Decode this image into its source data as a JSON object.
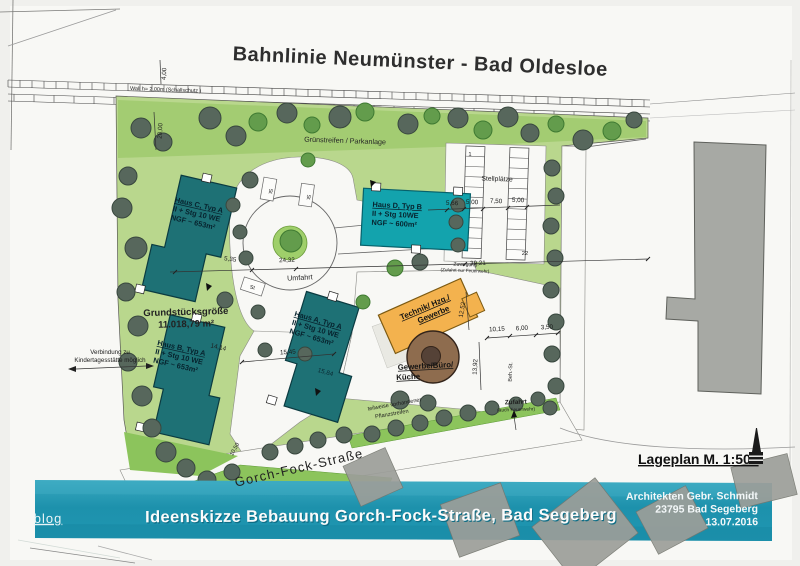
{
  "plan": {
    "railway": "Bahnlinie Neumünster - Bad Oldesloe",
    "wall": "Wall h= 2,00m   (Schallschutz )",
    "green_strip": "Grünstreifen / Parkanlage",
    "stellplaetze": "Stellplätze",
    "stall_first": "1",
    "stall_last": "22",
    "st": "St",
    "umfahrt": "Umfahrt",
    "plot_size_1": "Grundstücksgröße",
    "plot_size_2": "11.018,79 m²",
    "kita_1": "Verbindung zu",
    "kita_2": "Kindertagesstätte möglich",
    "pflanz_1": "teilweise vorhandener",
    "pflanz_2": "Pflanzstreifen",
    "zufahrt_1": "Zufahrt",
    "zufahrt_2": "(auch Feuerwehr)",
    "zuwegung_1": "Zuwegung",
    "zuwegung_2": "(Zufahrt nur Feuerwehr)",
    "street": "Gorch-Fock-Straße",
    "scale": "Lageplan M. 1:500",
    "beh_st": "Beh.-St."
  },
  "buildings": {
    "haus_c": {
      "name": "Haus C, Typ A",
      "line2": "II + Stg 10 WE",
      "line3": "NGF ~ 653m²"
    },
    "haus_d": {
      "name": "Haus D,  Typ B",
      "line2": "II + Stg 10WE",
      "line3": "NGF ~ 600m²"
    },
    "haus_a": {
      "name": "Haus A, Typ A",
      "line2": "II + Stg 10 WE",
      "line3": "NGF ~ 653m²"
    },
    "haus_b": {
      "name": "Haus B, Typ A",
      "line2": "II + Stg 10 WE",
      "line3": "NGF ~ 653m²"
    },
    "technik": {
      "line1": "Technik/ Hzg./",
      "line2": "Gewerbe"
    },
    "gewerbe": {
      "line1": "Gewerbe/Büro/",
      "line2": "Küche"
    }
  },
  "dims": {
    "v400": "4,00",
    "v2000": "20,00",
    "v535": "5,35",
    "v2432": "24,32",
    "v3921": "39,21",
    "v566": "5,66",
    "v500a": "5,00",
    "v750": "7,50",
    "v500b": "5,00",
    "v1414": "14,14",
    "v1545": "15,45",
    "v1584": "15,84",
    "v1015": "10,15",
    "v600": "6,00",
    "v350": "3,50",
    "v1392": "13,92",
    "v1252": "12,52",
    "v1050": "10,50"
  },
  "banner": {
    "title": "Ideenskizze Bebauung Gorch-Fock-Straße, Bad Segeberg",
    "watermark": "blog",
    "arch_1": "Architekten Gebr. Schmidt",
    "arch_2": "23795 Bad Segeberg",
    "arch_3": "13.07.2016"
  },
  "colors": {
    "banner_teal": "#1d99b4",
    "building_teal_dark": "#1e7175",
    "building_teal_light": "#13a3ad",
    "technik_orange": "#f3b24e",
    "gewerbe_brown": "#8e6c4e",
    "site_green": "#b9d78d",
    "strip_green": "#8cc45c",
    "tree_dark": "#57675c"
  }
}
